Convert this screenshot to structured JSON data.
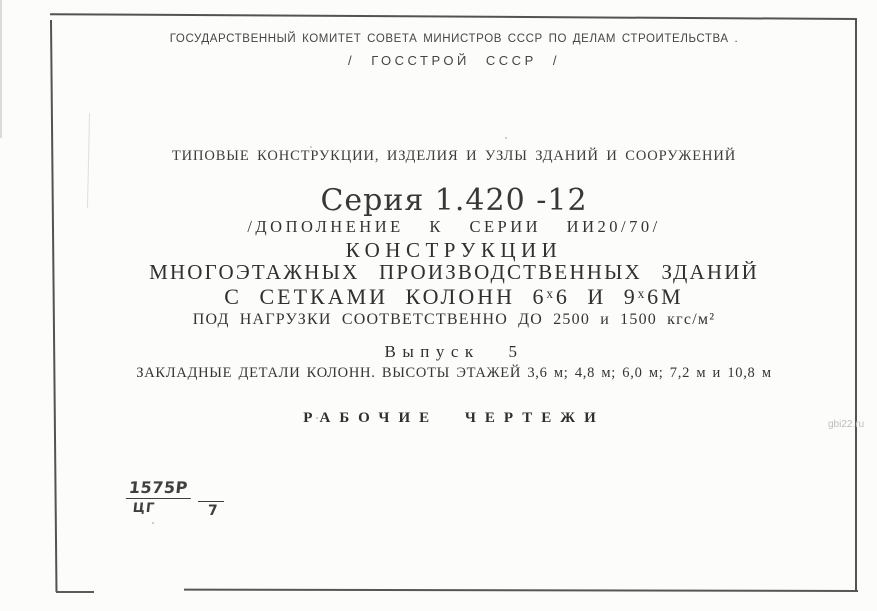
{
  "page": {
    "header": {
      "committee": "ГОСУДАРСТВЕННЫЙ КОМИТЕТ СОВЕТА МИНИСТРОВ СССР ПО ДЕЛАМ СТРОИТЕЛЬСТВА .",
      "gosstroy": "/ ГОССТРОЙ СССР /"
    },
    "category": "ТИПОВЫЕ КОНСТРУКЦИИ, ИЗДЕЛИЯ И УЗЛЫ ЗДАНИЙ И СООРУЖЕНИЙ",
    "series": {
      "title": "Серия 1.420 -12",
      "supplement": "/ДОПОЛНЕНИЕ К СЕРИИ ИИ20/70/"
    },
    "title": {
      "line1": "КОНСТРУКЦИИ",
      "line2": "МНОГОЭТАЖНЫХ ПРОИЗВОДСТВЕННЫХ ЗДАНИЙ",
      "line3": "С СЕТКАМИ КОЛОНН 6ˣ6 И 9ˣ6М",
      "line4": "ПОД НАГРУЗКИ СООТВЕТСТВЕННО ДО 2500 и 1500 кгс/м²"
    },
    "issue": {
      "label": "Выпуск 5",
      "contents": "ЗАКЛАДНЫЕ ДЕТАЛИ КОЛОНН. ВЫСОТЫ ЭТАЖЕЙ 3,6 м; 4,8 м; 6,0 м; 7,2 м и 10,8 м"
    },
    "doc_type": "РАБОЧИЕ ЧЕРТЕЖИ",
    "stamp": {
      "numerator": "1575Р",
      "denominator": "ЦГ",
      "sheet": "7"
    },
    "watermark": "gbi22.ru",
    "colors": {
      "paper": "#fcfcfa",
      "ink": "#3a3a3a",
      "border": "#535353",
      "watermark": "#bcbcbc"
    }
  }
}
